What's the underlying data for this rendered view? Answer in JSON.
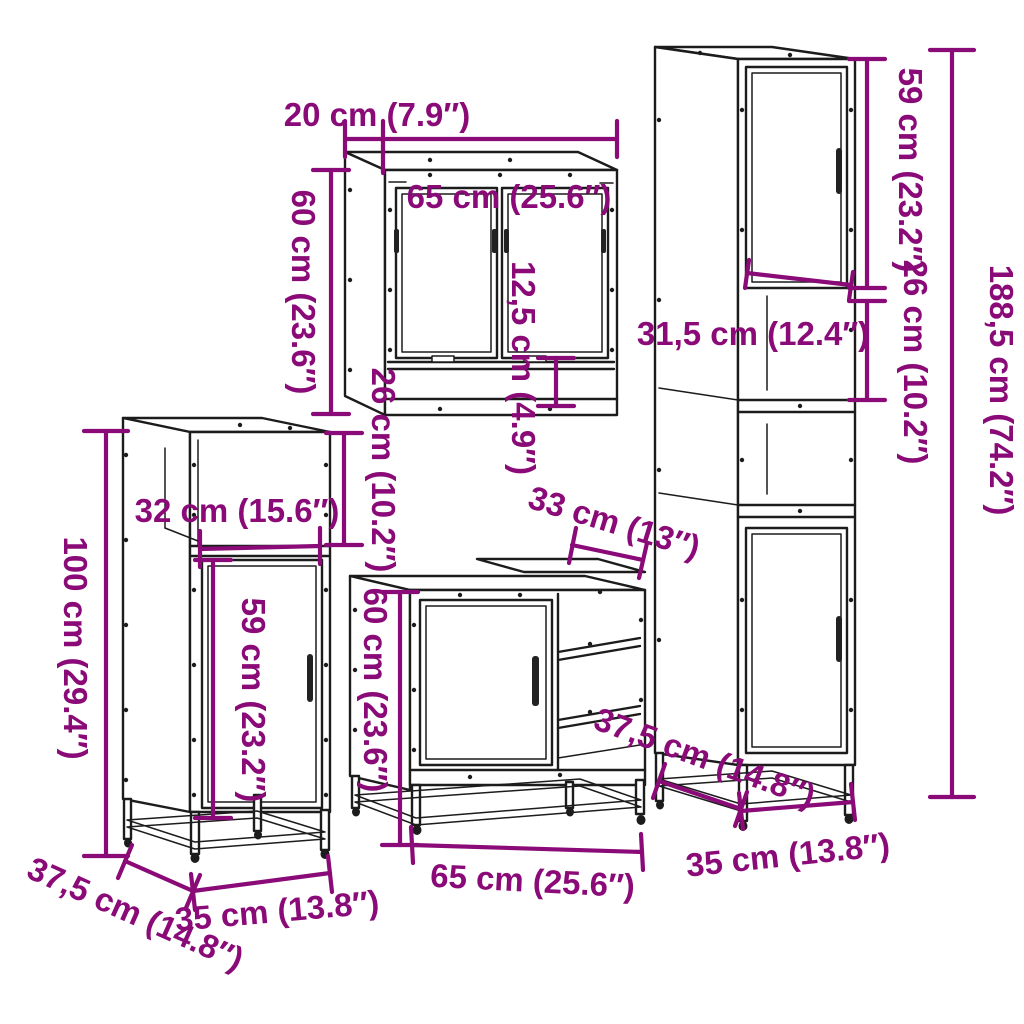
{
  "title": "4 Piece Bathroom Furniture Set — dimension diagram",
  "colors": {
    "dimension": "#8a0a78",
    "line_art": "#1c1c1c",
    "background": "#ffffff"
  },
  "pieces": {
    "mirror_cabinet": {
      "depth": "20 cm (7.9″)",
      "width": "65 cm (25.6″)",
      "height": "60 cm (23.6″)",
      "shelf_height": "12,5 cm (4.9″)"
    },
    "side_cabinet": {
      "compartment_height": "26 cm (10.2″)",
      "shelf_width": "32 cm (15.6″)",
      "door_height": "59 cm (23.2″)",
      "height": "100 cm (29.4″)",
      "depth": "37,5 cm (14.8″)",
      "width": "35 cm (13.8″)"
    },
    "sink_cabinet": {
      "top_section_width": "33 cm (13″)",
      "height": "60 cm (23.6″)",
      "width": "65 cm (25.6″)"
    },
    "tall_cabinet": {
      "door_height": "59 cm (23.2″)",
      "compartment_height": "26 cm (10.2″)",
      "inner_width": "31,5 cm (12.4″)",
      "height": "188,5 cm (74.2″)",
      "depth": "37,5 cm (14.8″)",
      "width": "35 cm (13.8″)"
    }
  }
}
